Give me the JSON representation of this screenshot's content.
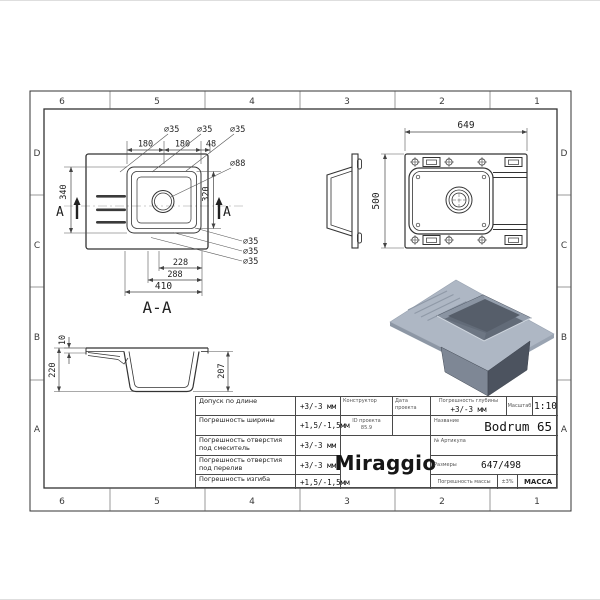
{
  "zones": {
    "cols": [
      "6",
      "5",
      "4",
      "3",
      "2",
      "1"
    ],
    "rows": [
      "D",
      "C",
      "B",
      "A"
    ]
  },
  "plan": {
    "dia35": "∅35",
    "dia88": "∅88",
    "dim180a": "180",
    "dim180b": "180",
    "dim48": "48",
    "dim340": "340",
    "dim320": "320",
    "dim228": "228",
    "dim288": "288",
    "dim410": "410",
    "section_letter": "A",
    "section_label": "A-A"
  },
  "views": {
    "width649": "649",
    "height500": "500"
  },
  "section": {
    "dim220": "220",
    "dim207": "207",
    "dim10": "10"
  },
  "titleblock": {
    "tolerances": [
      {
        "label": "Допуск по длине",
        "value": "+3/-3 мм"
      },
      {
        "label": "Погрешность ширины",
        "value": "+1,5/-1,5мм"
      },
      {
        "label": "Погрешность отверстия под смеситель",
        "value": "+3/-3 мм"
      },
      {
        "label": "Погрешность отверстия под перелив",
        "value": "+3/-3 мм"
      },
      {
        "label": "Погрешность изгиба",
        "value": "+1,5/-1,5мм"
      }
    ],
    "designer_label": "Конструктор",
    "date_label": "Дата проекта",
    "project_label": "ID проекта",
    "project_value": "85.9",
    "brand": "Miraggio",
    "depth_label": "Погрешность глубины",
    "depth_value": "+3/-3 мм",
    "scale_label": "Масштаб",
    "scale_value": "1:10",
    "name_label": "Название",
    "name_value": "Bodrum 65",
    "article_label": "№ Артикула",
    "size_label": "Размеры",
    "size_value": "647/498",
    "mass_tol_label": "Погрешность массы",
    "mass_tol_value": "±3%",
    "mass_label": "МАССА"
  },
  "colors": {
    "accent_top": "#aeb7c4",
    "bowl_dark": "#4c535f",
    "line": "#333333"
  }
}
